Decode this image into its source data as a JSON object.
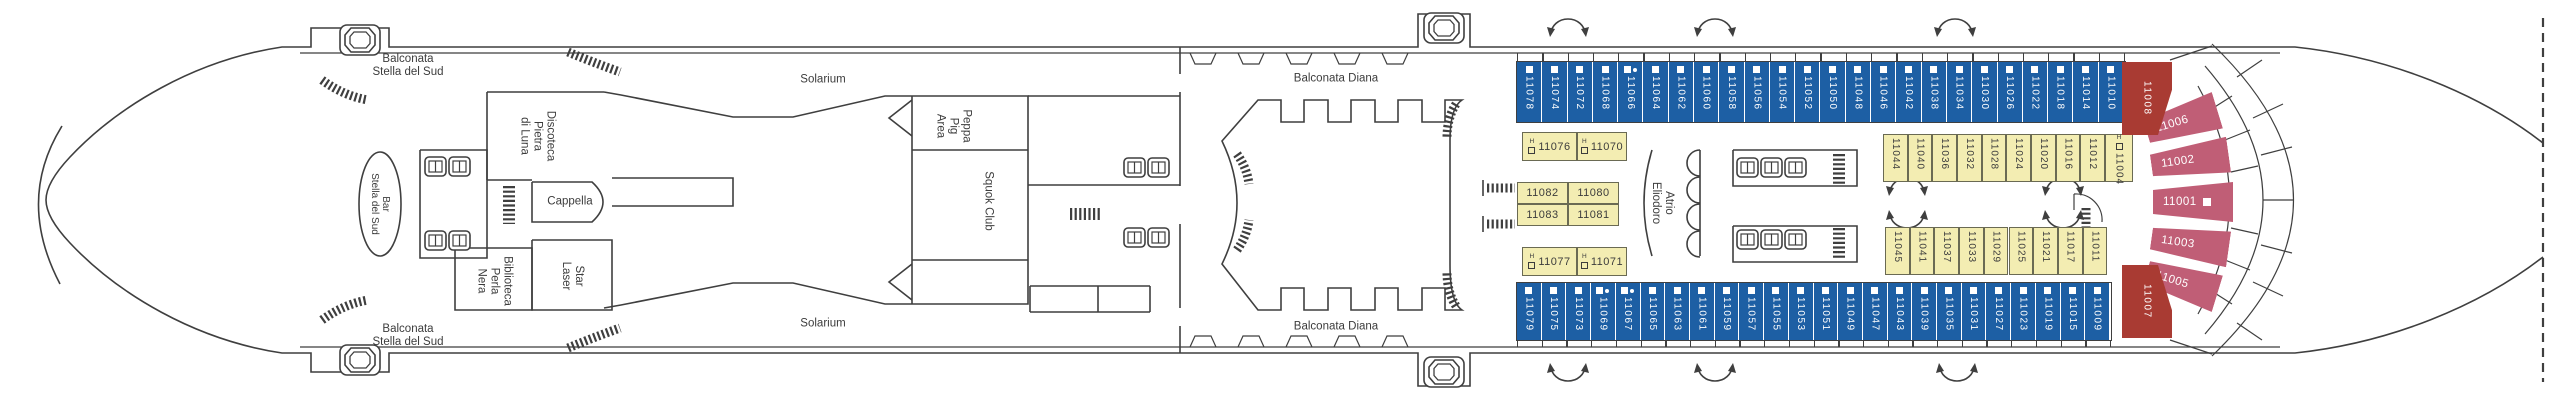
{
  "labels": {
    "balconata_stella": {
      "line1": "Balconata",
      "line2": "Stella del Sud"
    },
    "bar_stella": {
      "line1": "Bar",
      "line2": "Stella del Sud"
    },
    "discoteca": {
      "line1": "Discoteca",
      "line2": "Pietra",
      "line3": "di Luna"
    },
    "cappella": "Cappella",
    "biblioteca": {
      "line1": "Biblioteca",
      "line2": "Perla",
      "line3": "Nera"
    },
    "star_laser": {
      "line1": "Star",
      "line2": "Laser"
    },
    "solarium": "Solarium",
    "peppa": {
      "line1": "Peppa",
      "line2": "Pig",
      "line3": "Area"
    },
    "squok": "Squok Club",
    "balconata_diana": "Balconata Diana",
    "atrio": {
      "line1": "Atrio",
      "line2": "Eliodoro"
    }
  },
  "cabins": {
    "top_blue": [
      "11078",
      "11074",
      "11072",
      "11068",
      "11066",
      "11064",
      "11062",
      "11060",
      "11058",
      "11056",
      "11054",
      "11052",
      "11050",
      "11048",
      "11046",
      "11042",
      "11038",
      "11034",
      "11030",
      "11026",
      "11022",
      "11018",
      "11014",
      "11010"
    ],
    "bottom_blue": [
      "11079",
      "11075",
      "11073",
      "11069",
      "11067",
      "11065",
      "11063",
      "11061",
      "11059",
      "11057",
      "11055",
      "11053",
      "11051",
      "11049",
      "11047",
      "11043",
      "11039",
      "11035",
      "11031",
      "11027",
      "11023",
      "11019",
      "11015",
      "11009"
    ],
    "top_yellow": [
      "11044",
      "11040",
      "11036",
      "11032",
      "11028",
      "11024",
      "11020",
      "11016",
      "11012",
      "11004"
    ],
    "bottom_yellow": [
      "11045",
      "11041",
      "11037",
      "11033",
      "11029",
      "11025",
      "11021",
      "11017",
      "11011"
    ],
    "left_yellow_top": [
      "11076",
      "11070"
    ],
    "left_yellow_mid": [
      "11082",
      "11080",
      "11083",
      "11081"
    ],
    "left_yellow_bottom": [
      "11077",
      "11071"
    ],
    "stern_red": [
      "11008",
      "11007"
    ],
    "stern_fan": [
      "11006",
      "11002",
      "11001",
      "11003",
      "11005"
    ],
    "markers": {
      "dot": [
        "11066",
        "11067",
        "11069"
      ],
      "accessible": [
        "11076",
        "11070",
        "11077",
        "11071",
        "11004"
      ],
      "square_suffix": [
        "11001"
      ]
    }
  },
  "icons": {
    "accessible_glyph": "H"
  },
  "colors": {
    "balcony_cabin_blue": "#1d5fa4",
    "inside_cabin_yellow": "#f3edb2",
    "suite_red": "#a93b33",
    "suite_pink": "#c05e76",
    "line": "#3f3f3f",
    "text": "#3c3c3c"
  }
}
